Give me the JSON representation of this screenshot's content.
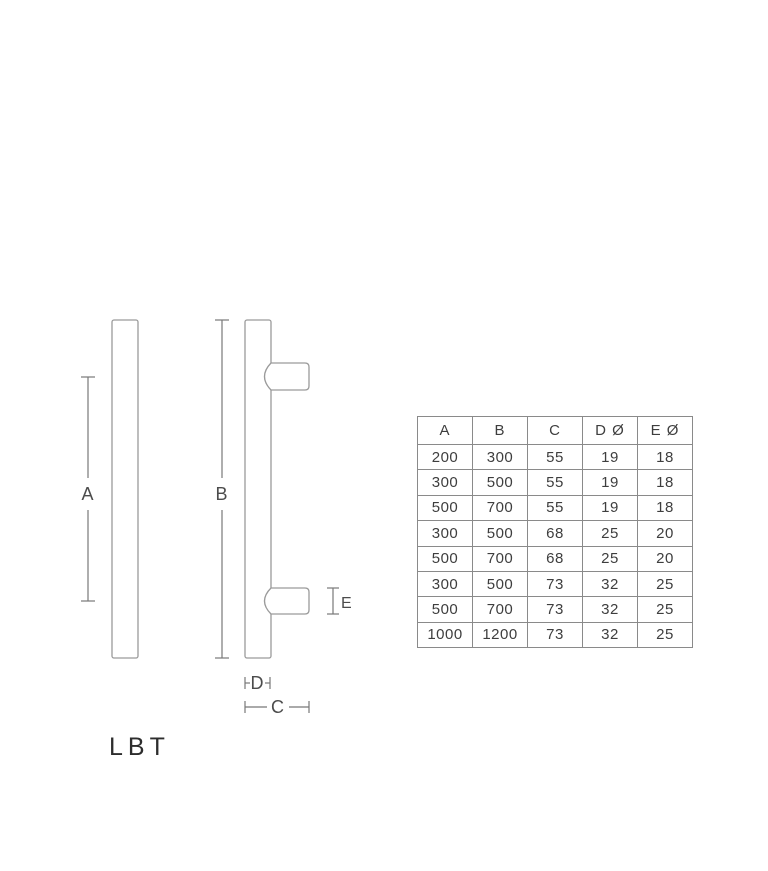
{
  "product_label": "LBT",
  "diagram": {
    "labels": {
      "a": "A",
      "b": "B",
      "c": "C",
      "d": "D",
      "e": "E"
    },
    "views": [
      "front-view-handle",
      "side-view-handle"
    ]
  },
  "table": {
    "headers": [
      "A",
      "B",
      "C",
      "D Ø",
      "E Ø"
    ],
    "rows": [
      [
        "200",
        "300",
        "55",
        "19",
        "18"
      ],
      [
        "300",
        "500",
        "55",
        "19",
        "18"
      ],
      [
        "500",
        "700",
        "55",
        "19",
        "18"
      ],
      [
        "300",
        "500",
        "68",
        "25",
        "20"
      ],
      [
        "500",
        "700",
        "68",
        "25",
        "20"
      ],
      [
        "300",
        "500",
        "73",
        "32",
        "25"
      ],
      [
        "500",
        "700",
        "73",
        "32",
        "25"
      ],
      [
        "1000",
        "1200",
        "73",
        "32",
        "25"
      ]
    ]
  },
  "colors": {
    "background": "#ffffff",
    "outline": "#9a9a9a",
    "dimension_line": "#787878",
    "table_border": "#8a8a8a",
    "text": "#3e3e3e"
  }
}
